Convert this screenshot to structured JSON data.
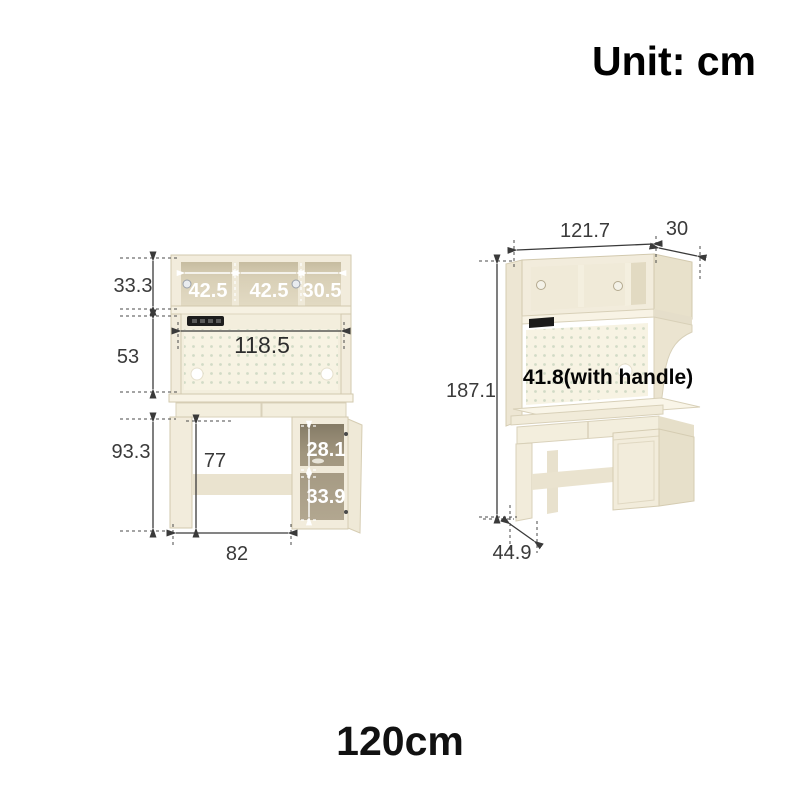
{
  "title": {
    "unit_label": "Unit: cm",
    "size_label": "120cm"
  },
  "front_view": {
    "hutch_height": "33.3",
    "shelf_widths": [
      "42.5",
      "42.5",
      "30.5"
    ],
    "pegboard_width": "118.5",
    "back_panel_height": "53",
    "desk_height": "93.3",
    "legroom_height": "77",
    "cabinet_top_height": "28.1",
    "cabinet_bottom_height": "33.9",
    "legroom_width": "82"
  },
  "side_view": {
    "total_width": "121.7",
    "hutch_depth": "30",
    "total_height": "187.1",
    "desk_depth_note": "41.8(with handle)",
    "base_depth": "44.9"
  },
  "colors": {
    "background": "#ffffff",
    "furniture_cream": "#f2ecdc",
    "interior_tan": "#d8cfb6",
    "cabinet_interior": "#a79d89",
    "pegboard": "#f7f3e3",
    "dimension_line": "#3a3a3a",
    "label_white": "#ffffff"
  }
}
